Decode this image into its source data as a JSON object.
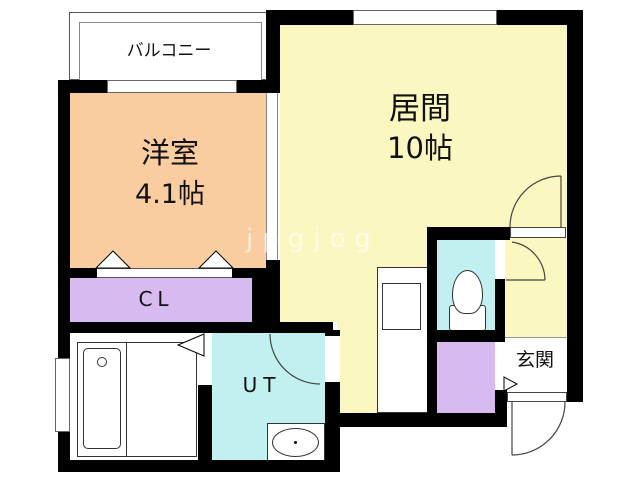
{
  "floorplan": {
    "rooms": {
      "balcony": {
        "label": "バルコニー"
      },
      "western_room": {
        "label": "洋室",
        "size": "4.1帖"
      },
      "living": {
        "label": "居間",
        "size": "10帖"
      },
      "closet": {
        "label": "CL"
      },
      "utility": {
        "label": "UT"
      },
      "entrance": {
        "label": "玄関"
      }
    },
    "watermark": "jpgjog",
    "colors": {
      "western_room": "#FACDA0",
      "living": "#FAF7C0",
      "utility_and_toilet": "#C2F0F0",
      "closets": "#D7BAF0",
      "walls": "#000000",
      "balcony_and_bath": "#FFFFFF"
    }
  }
}
